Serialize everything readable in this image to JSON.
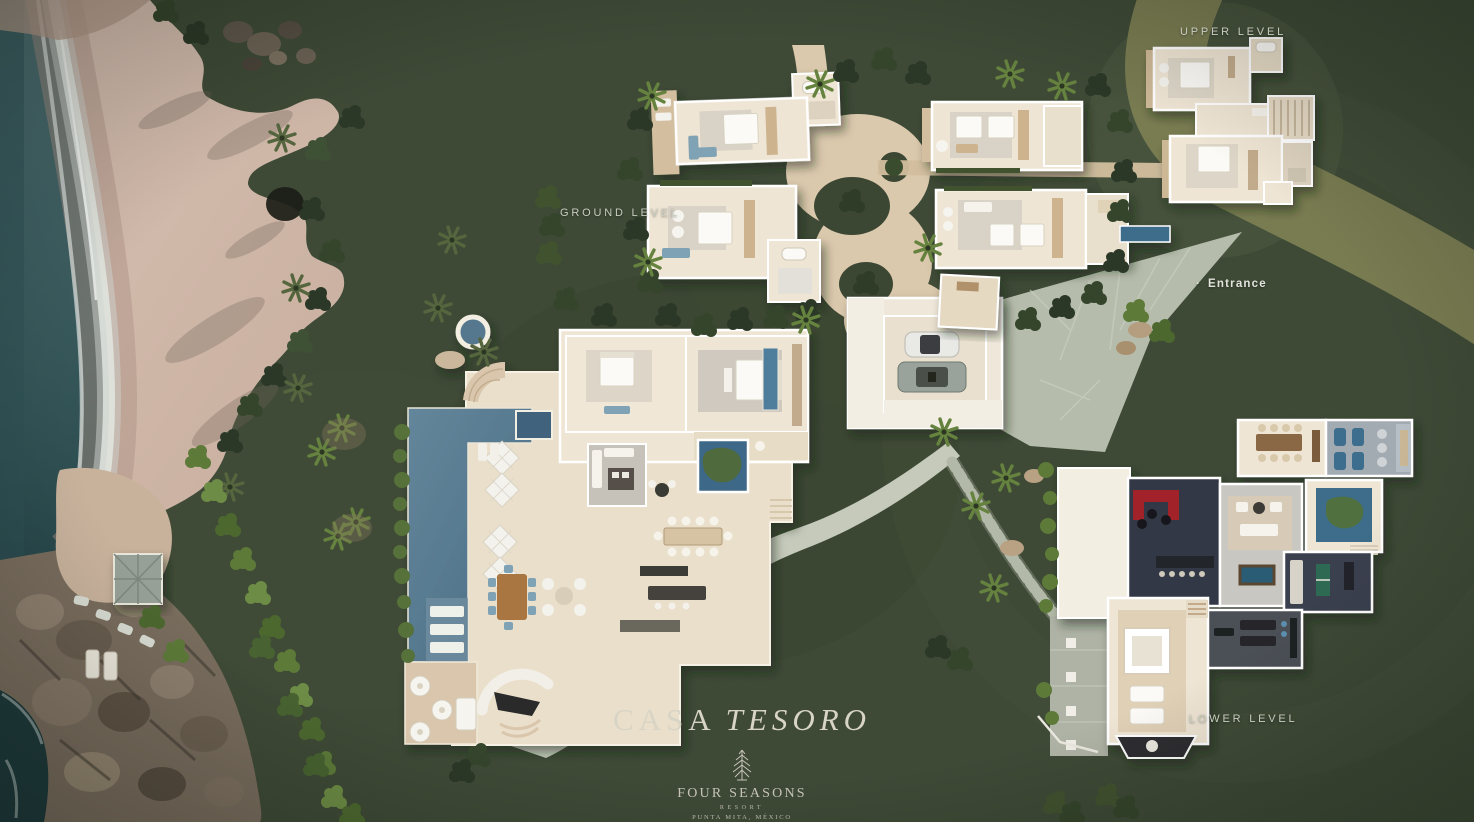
{
  "title": {
    "word1": "CASA",
    "word2": "TESORO"
  },
  "labels": {
    "upper_level": "UPPER LEVEL",
    "ground_level": "GROUND LEVEL",
    "entrance_bullet": "·",
    "entrance": "Entrance",
    "lower_level": "LOWER LEVEL"
  },
  "brand": {
    "name": "FOUR SEASONS",
    "subtitle": "RESORT",
    "location": "PUNTA MITA, MÉXICO",
    "tree_icon": "four-seasons-tree-icon"
  },
  "palette": {
    "grass": "#3e4936",
    "grass_light_ring": "#4e5a41",
    "road_olive": "#7e8054",
    "beach_sand": "#d5bfb0",
    "wet_sand": "#ab9183",
    "ocean": "#35565a",
    "foam": "#e3e8e4",
    "rock": "#786c5d",
    "sand_path": "#dbc9ad",
    "stone_path": "#c5cabb",
    "flagstone": "#b6bcab",
    "wall_white": "#ffffff",
    "floor_cream": "#efe5d4",
    "wood": "#cdb48f",
    "pool_blue": "#54788e",
    "pool_dark": "#3f627c",
    "plunge_blue": "#3e6d8a",
    "dark_room": "#333944",
    "gym_gray": "#4b4f56",
    "media_gray": "#a3abb2",
    "accent_red": "#a2242c",
    "accent_blue": "#7fa3b5",
    "label_text": "#c9ccc0"
  }
}
